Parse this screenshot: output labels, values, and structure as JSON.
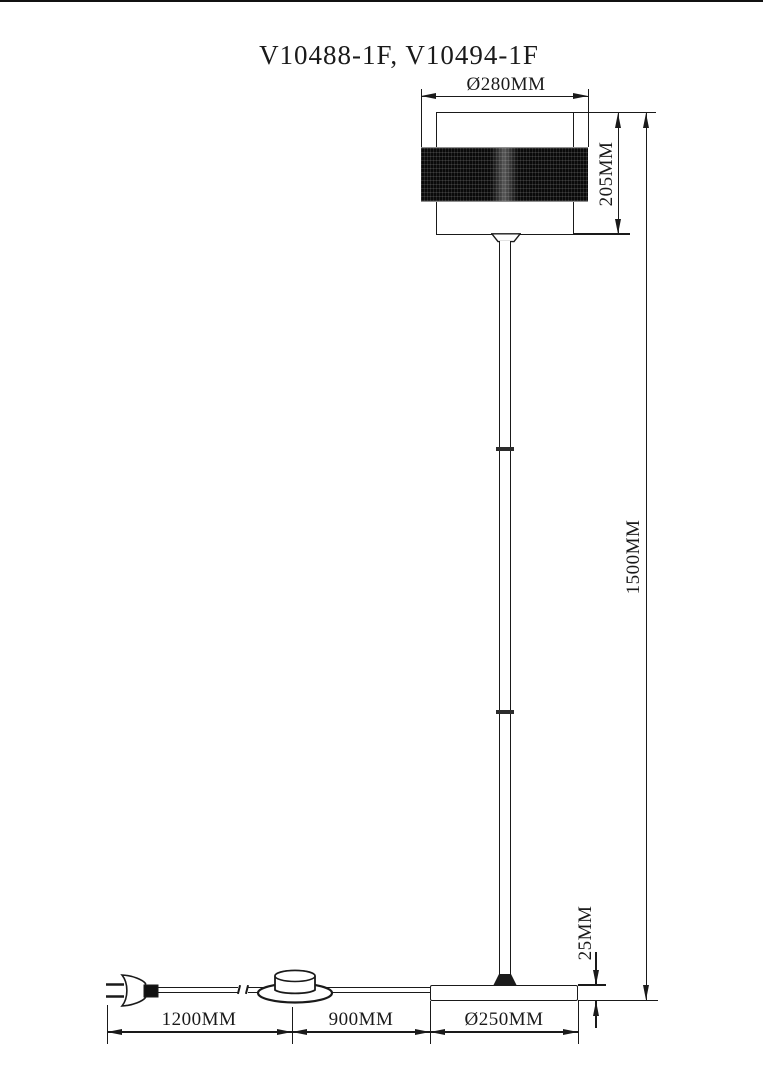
{
  "title": "V10488-1F, V10494-1F",
  "dimensions": {
    "shade_diameter": "Ø280MM",
    "shade_height": "205MM",
    "total_height": "1500MM",
    "base_thickness": "25MM",
    "cord_plug_to_switch": "1200MM",
    "cord_switch_to_base": "900MM",
    "base_diameter": "Ø250MM"
  },
  "colors": {
    "line": "#1a1a1a",
    "background": "#ffffff",
    "shade_band": "#0a0a0a"
  }
}
